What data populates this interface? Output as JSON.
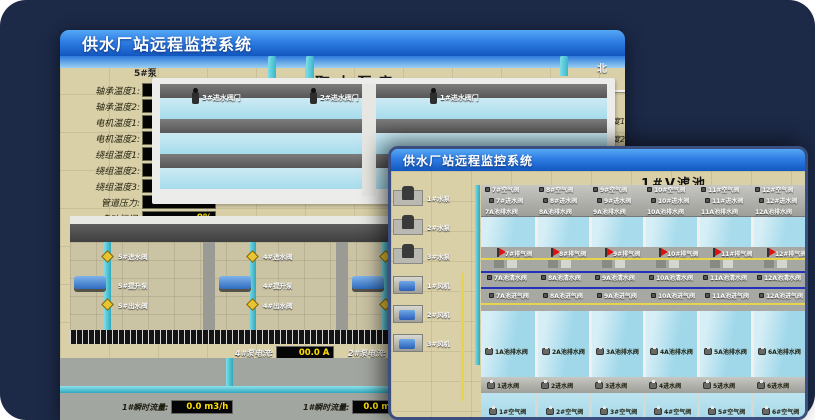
{
  "colors": {
    "background_navy": "#1c2947",
    "titlebar_blue_top": "#55a8f5",
    "titlebar_blue_bottom": "#1257c0",
    "readout_text_yellow": "#ffe000",
    "readout_bg_black": "#050505",
    "ground_tan": "#d9d0a8",
    "water_blue": "#a8dcec",
    "pipe_cyan": "#3fb8cb",
    "valve_yellow": "#e8c530",
    "alarm_flag_red": "#e01010",
    "pipe_line_yellow": "#e6d44c",
    "pipe_line_blue": "#2233bb"
  },
  "back_window": {
    "title": "供水厂站远程监控系统",
    "scene_title": "取水泵房",
    "panel": {
      "header": "5#泵",
      "fields": [
        {
          "label": "轴承温度1:",
          "value": "100.0℃"
        },
        {
          "label": "轴承温度2:",
          "value": "100.0℃"
        },
        {
          "label": "电机温度1:",
          "value": "18.1℃"
        },
        {
          "label": "电机温度2:",
          "value": "17.9℃"
        },
        {
          "label": "绕组温度1:",
          "value": "18.0℃"
        },
        {
          "label": "绕组温度2:",
          "value": "18.1℃"
        },
        {
          "label": "绕组温度3:",
          "value": "18.1℃"
        },
        {
          "label": "管道压力:",
          "value": "0.0007MPa"
        },
        {
          "label": "多功能阀:",
          "value": "0%"
        }
      ]
    },
    "compass": {
      "north": "北",
      "west": "西",
      "south": "南",
      "east": "东"
    },
    "side_labels": [
      {
        "label": "轴承温度1"
      },
      {
        "label": "轴承温度2"
      }
    ],
    "inlet_valves": [
      {
        "label": "3#进水阀门"
      },
      {
        "label": "2#进水阀门"
      },
      {
        "label": "1#进水阀门"
      }
    ],
    "pump_bays": [
      {
        "no": "5#",
        "inlet": "5#进水阀",
        "pump": "5#提升泵",
        "outlet": "5#出水阀"
      },
      {
        "no": "4#",
        "inlet": "4#进水阀",
        "pump": "4#提升泵",
        "outlet": "4#出水阀"
      },
      {
        "no": "3#",
        "inlet": "3#进水阀",
        "pump": "3#提升泵",
        "outlet": "3#出水阀"
      },
      {
        "no": "2#",
        "inlet": "2#进水阀",
        "pump": "2#提升泵",
        "outlet": "2#出水阀"
      }
    ],
    "current_readouts": [
      {
        "label": "4#泵电流:",
        "value": "00.0 A"
      },
      {
        "label": "2#泵电流:",
        "value": "00.0 A"
      }
    ],
    "flow_readouts": [
      {
        "label": "1#瞬时流量:",
        "value": "0.0 m3/h"
      },
      {
        "label": "1#瞬时流量:",
        "value": "0.0 m3/h"
      }
    ]
  },
  "front_window": {
    "title": "供水厂站远程监控系统",
    "scene_title": "1#V滤池",
    "pumps": [
      {
        "label": "1#水泵"
      },
      {
        "label": "2#水泵"
      },
      {
        "label": "3#水泵"
      }
    ],
    "fans": [
      {
        "label": "1#风机"
      },
      {
        "label": "2#风机"
      },
      {
        "label": "3#风机"
      }
    ],
    "top_cells": [
      {
        "air": "7#空气阀",
        "inlet": "7#进水阀",
        "drain": "7A池排水阀",
        "vent": "7#排气阀",
        "clean": "7A池清水阀",
        "air_in": "7A池进气阀"
      },
      {
        "air": "8#空气阀",
        "inlet": "8#进水阀",
        "drain": "8A池排水阀",
        "vent": "8#排气阀",
        "clean": "8A池清水阀",
        "air_in": "8A池进气阀"
      },
      {
        "air": "9#空气阀",
        "inlet": "9#进水阀",
        "drain": "9A池排水阀",
        "vent": "9#排气阀",
        "clean": "9A池清水阀",
        "air_in": "9A池进气阀"
      },
      {
        "air": "10#空气阀",
        "inlet": "10#进水阀",
        "drain": "10A池排水阀",
        "vent": "10#排气阀",
        "clean": "10A池清水阀",
        "air_in": "10A池进气阀"
      },
      {
        "air": "11#空气阀",
        "inlet": "11#进水阀",
        "drain": "11A池排水阀",
        "vent": "11#排气阀",
        "clean": "11A池清水阀",
        "air_in": "11A池进气阀"
      },
      {
        "air": "12#空气阀",
        "inlet": "12#进水阀",
        "drain": "12A池排水阀",
        "vent": "12#排气阀",
        "clean": "12A池清水阀",
        "air_in": "12A池进气阀"
      }
    ],
    "bottom_cells": [
      {
        "drain": "1A池排水阀",
        "inlet": "1进水阀",
        "air": "1#空气阀"
      },
      {
        "drain": "2A池排水阀",
        "inlet": "2进水阀",
        "air": "2#空气阀"
      },
      {
        "drain": "3A池排水阀",
        "inlet": "3进水阀",
        "air": "3#空气阀"
      },
      {
        "drain": "4A池排水阀",
        "inlet": "4进水阀",
        "air": "4#空气阀"
      },
      {
        "drain": "5A池排水阀",
        "inlet": "5进水阀",
        "air": "5#空气阀"
      },
      {
        "drain": "6A池排水阀",
        "inlet": "6进水阀",
        "air": "6#空气阀"
      }
    ]
  }
}
